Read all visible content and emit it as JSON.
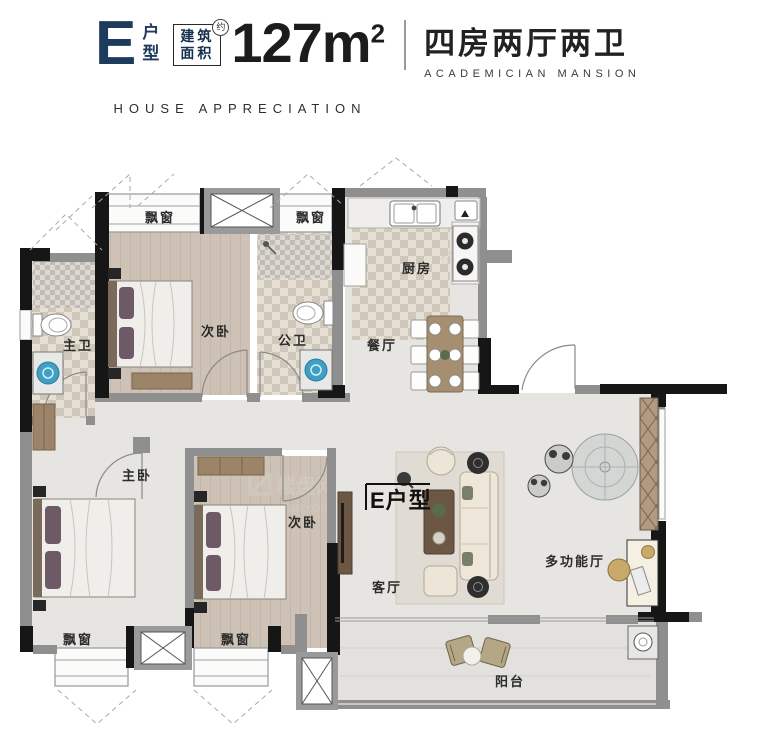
{
  "header": {
    "plan_letter": "E",
    "plan_suffix_top": "户",
    "plan_suffix_bottom": "型",
    "area_box_line1": "建筑",
    "area_box_line2": "面积",
    "area_box_note": "约",
    "area_value": "127m",
    "area_sup": "2",
    "title_cn": "四房两厅两卫",
    "title_en": "ACADEMICIAN MANSION",
    "subtitle_en": "HOUSE APPRECIATION"
  },
  "plan": {
    "rooms": {
      "bay_window_top_left": "飘窗",
      "bay_window_top_right": "飘窗",
      "kitchen": "厨房",
      "master_bath": "主卫",
      "bedroom_top": "次卧",
      "public_bath": "公卫",
      "dining": "餐厅",
      "master_bedroom": "主卧",
      "bedroom_second": "次卧",
      "plan_tag": "E户型",
      "living": "客厅",
      "multi_hall": "多功能厅",
      "balcony": "阳台",
      "bay_window_bottom_left": "飘窗",
      "bay_window_bottom_right": "飘窗"
    },
    "colors": {
      "wall_black": "#161616",
      "wall_gray": "#8f8f8f",
      "floor_main": "#e7e5e2",
      "floor_wood": "#cdc2b5",
      "floor_bath": "#ddd6cb",
      "accent_navy": "#1e3a5c",
      "washer_blue": "#3f9fc4"
    }
  },
  "watermark": {
    "name": "楼盘网",
    "domain": "LouPan.com"
  }
}
